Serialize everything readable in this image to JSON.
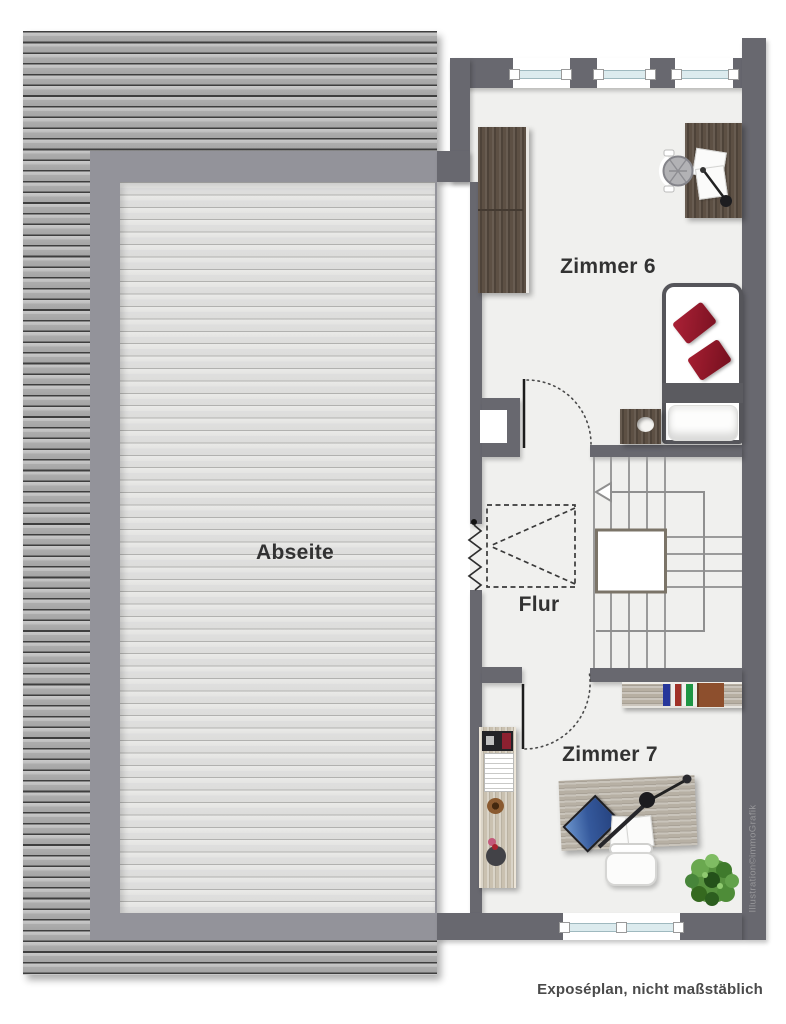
{
  "plan": {
    "type": "floor-plan",
    "rooms": [
      {
        "id": "abseite",
        "label": "Abseite"
      },
      {
        "id": "zimmer6",
        "label": "Zimmer 6"
      },
      {
        "id": "flur",
        "label": "Flur"
      },
      {
        "id": "zimmer7",
        "label": "Zimmer 7"
      }
    ],
    "footer_note": "Exposéplan, nicht maßstäblich",
    "watermark": "Illustration©immoGrafik",
    "stairs": {
      "flights": 3,
      "walkline_arrow": "left"
    },
    "windows": {
      "top_wall": 3,
      "bottom_wall": 1
    },
    "furniture": {
      "zimmer6": [
        "wardrobe",
        "desk",
        "desk-chair",
        "desk-lamp",
        "bed",
        "red-pillows",
        "nightstand"
      ],
      "zimmer7": [
        "shelf-with-binders",
        "sideboard",
        "desk",
        "laptop",
        "desk-lamp",
        "chair",
        "plant"
      ],
      "flur": [
        "loft-ladder-hatch",
        "chimney"
      ]
    }
  },
  "colors": {
    "wall": "#68686f",
    "floor": "#f0f0ee",
    "abseite_frame": "#93939a",
    "roof_stripe_dark": "#3e3e3e",
    "roof_stripe_light": "#c9c9c9",
    "window_glass": "#dcebee",
    "pillow_red": "#9a1a2b",
    "wood_dark": "#5d5044",
    "wood_light": "#b7afa2",
    "binder_blue": "#27379b",
    "binder_red": "#a03127",
    "binder_green": "#1d9544",
    "box_brown": "#8d4f2d",
    "plant_green": "#4e8c3a",
    "stair_line": "#9b9b9b"
  }
}
